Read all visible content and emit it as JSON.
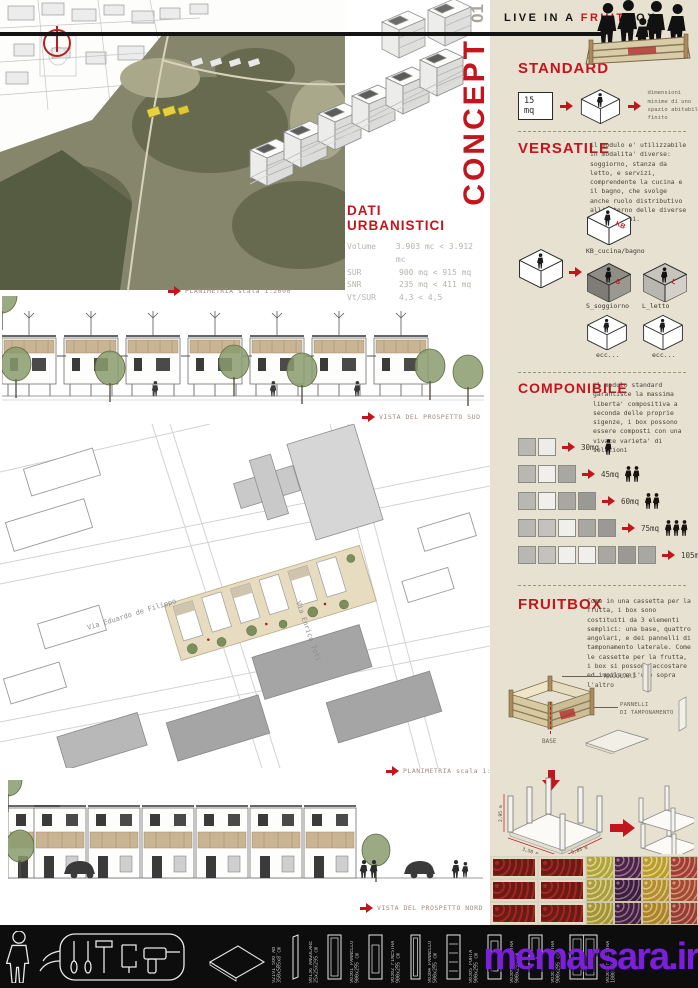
{
  "colors": {
    "accent_red": "#c3161c",
    "sidebar_bg": "#e7e1d1",
    "board_bg": "#ffffff",
    "footer_bg": "#0d0d0d",
    "watermark_purple": "#7c1fd9",
    "wood_tan": "#c9b493",
    "tree_green": "#8a9b6d"
  },
  "concept": {
    "word": "CONCEPT",
    "number": "01"
  },
  "header": {
    "pre": "LIVE IN A ",
    "fruit": "FRUIT",
    "box": "BOX"
  },
  "dati": {
    "title": "DATI URBANISTICI",
    "rows": [
      {
        "label": "Volume",
        "value": "3.903 mc < 3.912 mc"
      },
      {
        "label": "SUR",
        "value": "900 mq < 915 mq"
      },
      {
        "label": "SNR",
        "value": "235 mq < 411 mq"
      },
      {
        "label": "Vt/SUR",
        "value": "4,3 < 4,5"
      }
    ]
  },
  "captions": {
    "planimetria_2000": "PLANIMETRIA scala 1:2000",
    "prospetto_sud": "VISTA DEL PROSPETTO SUD",
    "planimetria_500": "PLANIMETRIA scala 1:500",
    "prospetto_nord": "VISTA DEL PROSPETTO NORD"
  },
  "plan": {
    "street_1": "Via Eduardo de Filippo",
    "street_2": "Via Enrico Toti"
  },
  "standard": {
    "title": "STANDARD",
    "badge": "15 mq",
    "note": "dimensioni minime\ndi uno spazio\nabitabile finito"
  },
  "versatile": {
    "title": "VERSATILE",
    "body": "il modulo e' utilizzabile in modalita' diverse: soggiorno, stanza da letto, e servizi, comprendente la cucina e il bagno, che svolge anche ruolo distributivo all'interno delle diverse composizioni.",
    "kb_code": "KB",
    "kb_label": "KB_cucina/bagno",
    "s_code": "S",
    "s_label": "S_soggiorno",
    "l_code": "L",
    "l_label": "L_letto",
    "ecc": "ecc..."
  },
  "componibile": {
    "title": "COMPONIBILE",
    "body": "il modulo standard garantisce la massima liberta' compositiva a seconda delle proprie sigenze, i box possono essere composti con una vivace varieta' di soluzioni",
    "rows": [
      {
        "label": "30mq",
        "people": 1,
        "shades": [
          "#b9b7b2",
          "#edece8"
        ]
      },
      {
        "label": "45mq",
        "people": 2,
        "shades": [
          "#b9b7b2",
          "#f0efeb",
          "#a9a7a2"
        ]
      },
      {
        "label": "60mq",
        "people": 2,
        "shades": [
          "#b9b7b2",
          "#f0efeb",
          "#a9a7a2",
          "#9b9994"
        ]
      },
      {
        "label": "75mq",
        "people": 3,
        "shades": [
          "#b9b7b2",
          "#c4c2bd",
          "#f0efeb",
          "#a9a7a2",
          "#9b9994"
        ]
      },
      {
        "label": "105mq",
        "people": 5,
        "shades": [
          "#b9b7b2",
          "#c4c2bd",
          "#f0efeb",
          "#f0efeb",
          "#a9a7a2",
          "#9b9994",
          "#a9a7a2"
        ]
      }
    ]
  },
  "fruitbox": {
    "title": "FRUITBOX",
    "body": "Come in una cassetta per la frutta, i box sono costituiti da 3 elementi semplici: una base, quattro angolari, e dei pannelli di tamponamento laterale. Come le cassette per la frutta, i box si possono accostare ed impilare l'uno sopra l'altro",
    "label_angolari": "ANGOLARI",
    "label_pannelli": "PANNELLI\nDI TAMPONAMENTO",
    "label_base": "BASE",
    "dim_h": "2,95 m",
    "dim_d": "3,50 m",
    "dim_w": "5,05 m"
  },
  "footer": {
    "panels": [
      "92191_500_AB\n350x505x8 cm",
      "90136_ANGOLARE\n25x25x295 cm",
      "90301_PANNELLO\n900x295 cm",
      "90302_FINESTRA\n900x295 cm",
      "90304_PANNELLO\n500x295 cm",
      "90305_PORTA\n900x295 cm",
      "90306_FINESTRA\n900x295 cm",
      "90307_FINESTRA\n900x295 cm",
      "90308_FINESTRA\n1800x295 cm"
    ],
    "watermark": "memarsara.ir"
  }
}
